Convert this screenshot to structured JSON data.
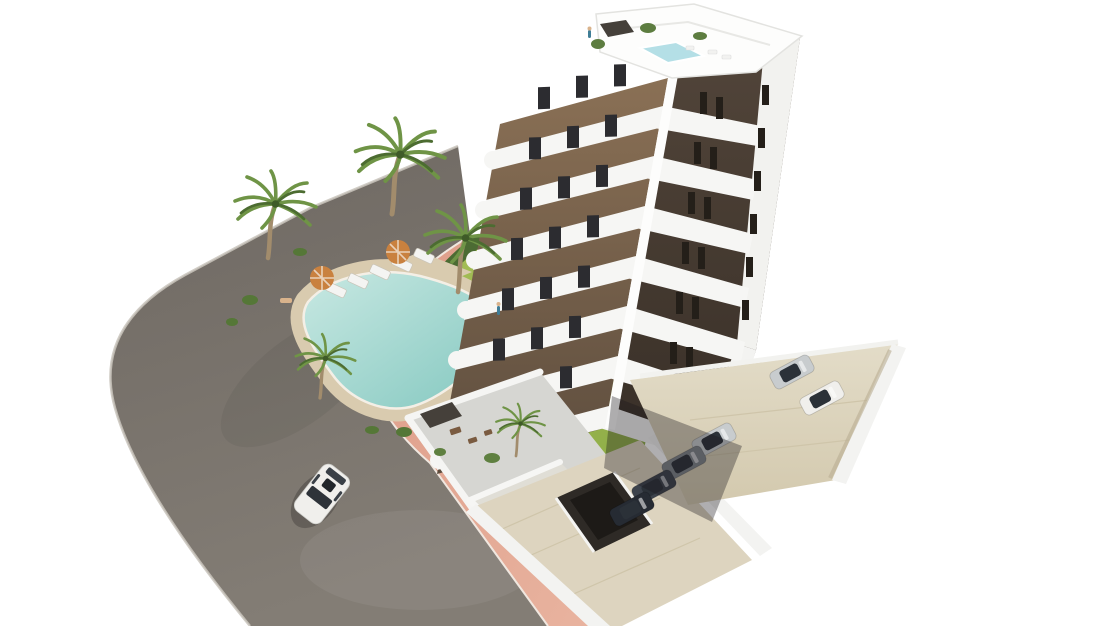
{
  "scene": {
    "type": "architectural-render",
    "view": "aerial-3d",
    "objects": {
      "building_floors_visible": 8,
      "palm_trees": 6,
      "parasols": 2,
      "sun_loungers": 5,
      "parked_cars": 6,
      "driving_cars": 1,
      "pools": 2
    }
  },
  "colors": {
    "background": "#ffffff",
    "road_top": "#6e6862",
    "road_bottom": "#837d75",
    "road_curb": "#c9c4bc",
    "sidewalk": "#dd9c88",
    "sidewalk_light": "#e9b4a0",
    "curb_line": "#f0e7df",
    "lawn_light": "#a6bf57",
    "lawn_dark": "#8cab45",
    "hedge": "#4c6b33",
    "bush": "#557737",
    "deck_sand": "#d9cbaf",
    "pool_edge": "#c8e8e2",
    "pool_deep": "#84c8c0",
    "pool_rim": "#f4efe6",
    "roof_pool": "#b4dfe6",
    "lounger": "#f4f4f2",
    "parasol": "#c9813f",
    "palm_trunk": "#a28c6c",
    "palm_frond": "#6f9446",
    "palm_frond_dark": "#4c6c31",
    "building_white": "#f6f6f4",
    "building_white_bright": "#fdfdfc",
    "building_edge": "#e3e3e0",
    "facade_brown_top": "#8a7055",
    "facade_brown_bottom": "#5d4d3e",
    "facade_dark_top": "#52453a",
    "facade_dark_bottom": "#382f27",
    "gable_white": "#f2f2ef",
    "window_dark": "#2c2c30",
    "window_slit": "#241f19",
    "terrace_floor": "#d6d6d2",
    "terrace_floor_light": "#e0ded6",
    "pergola": "#45403a",
    "furniture_brown": "#7a5b40",
    "concrete_light": "#e3dcc8",
    "concrete_dark": "#d3c9ae",
    "apron": "#ddd4bf",
    "ramp_dark": "#2e2a26",
    "ramp_deep": "#1d1a17",
    "wall_white": "#f3f3f1",
    "wall_shadow": "#b9ad92",
    "overhang_shadow": "rgba(25,22,28,0.35)",
    "car_white": "#f0efec",
    "car_silver": "#c8ccce",
    "car_gray": "#7e8489",
    "car_dark_blue": "#3d434c",
    "car_black": "#262b33",
    "car_glass": "#2b3138",
    "car_shadow": "rgba(0,0,0,0.22)",
    "person_blue": "#3f7d96",
    "person_skin": "#d9b38c"
  }
}
